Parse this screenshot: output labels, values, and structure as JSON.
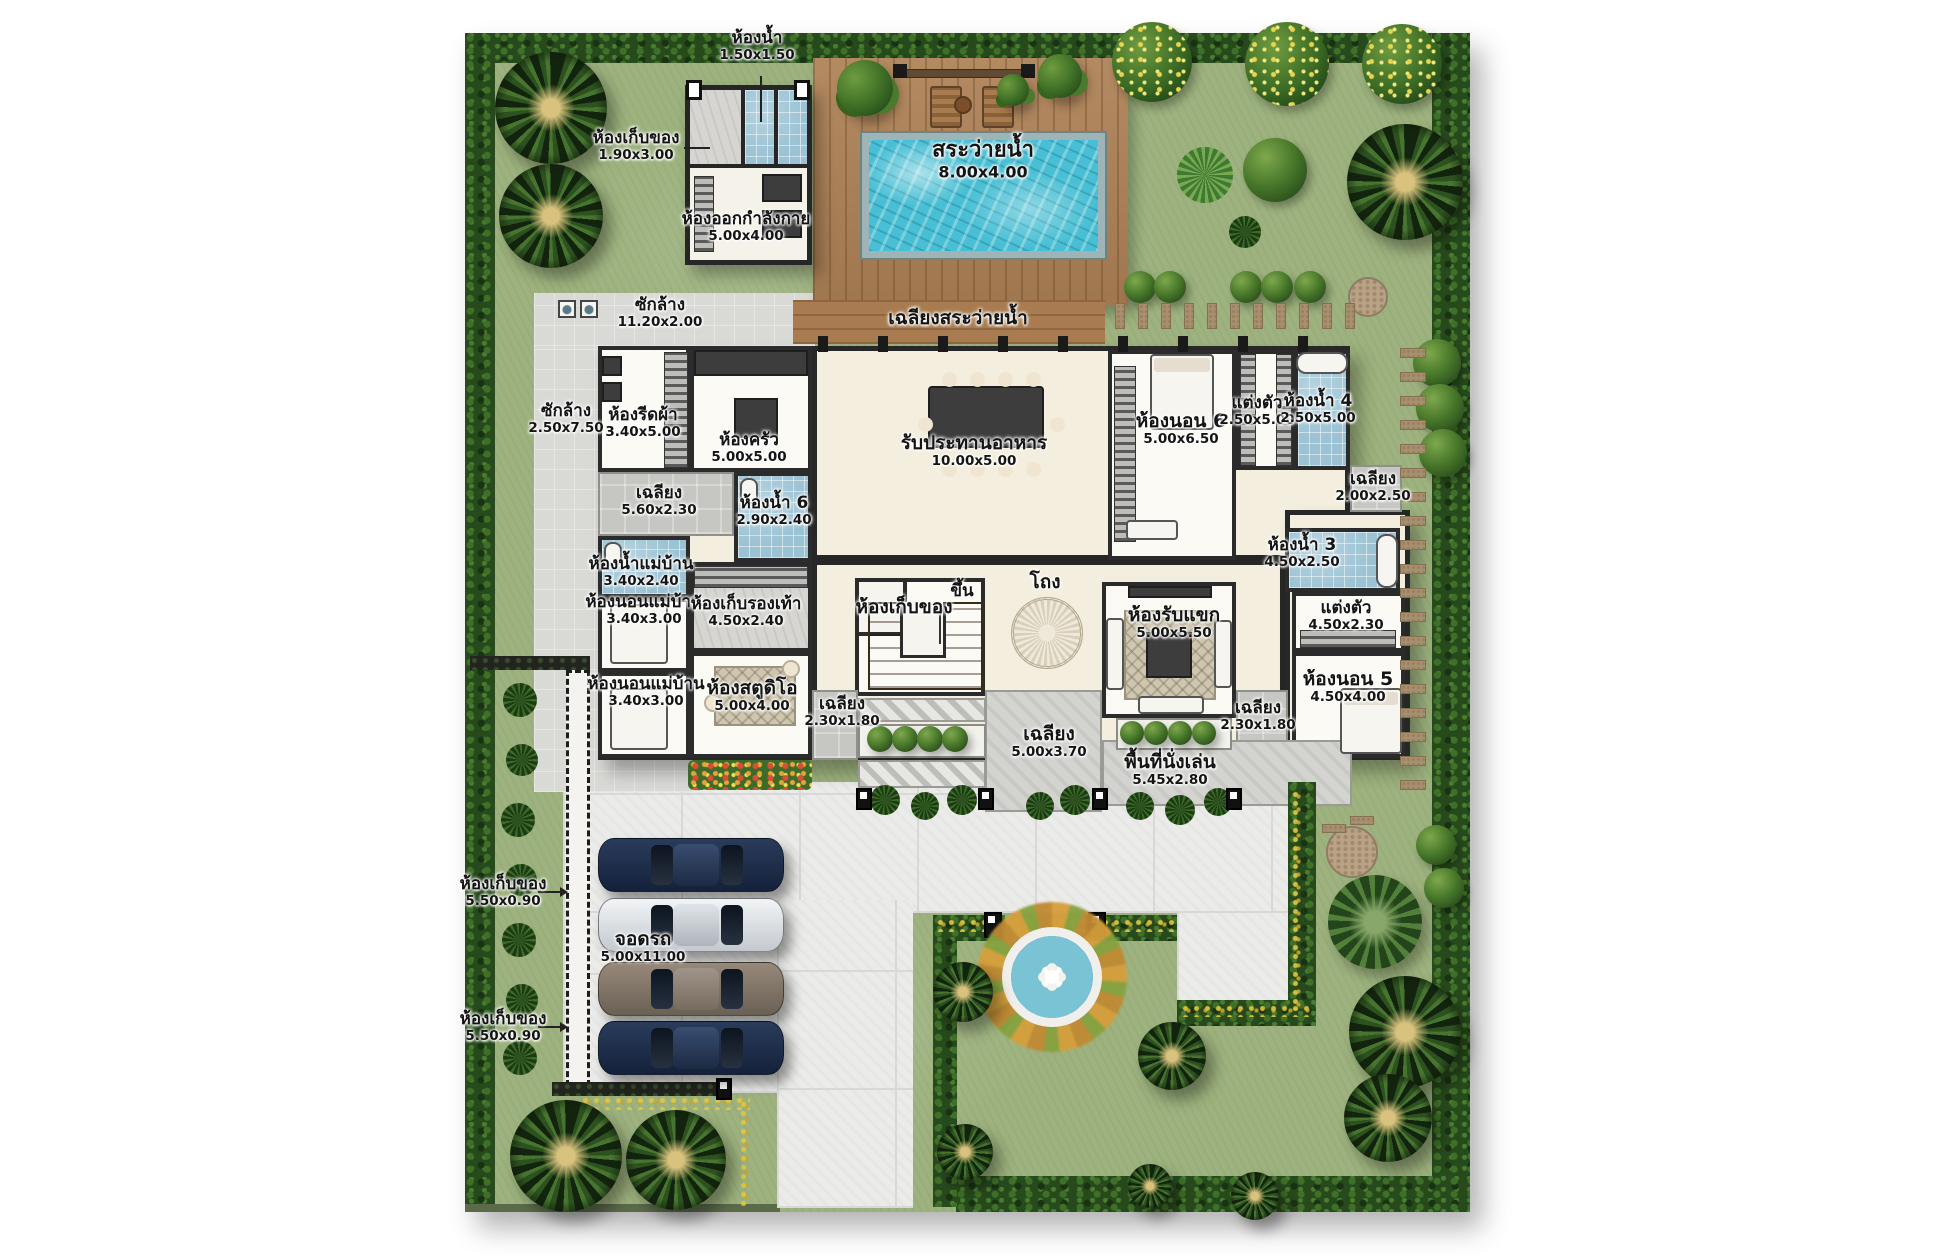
{
  "plan": {
    "rooms": {
      "bath_top": {
        "name": "ห้องน้ำ",
        "dim": "1.50x1.50"
      },
      "storage_top": {
        "name": "ห้องเก็บของ",
        "dim": "1.90x3.00"
      },
      "gym": {
        "name": "ห้องออกกำลังกาย",
        "dim": "5.00x4.00"
      },
      "pool": {
        "name": "สระว่ายน้ำ",
        "dim": "8.00x4.00"
      },
      "laundry_strip": {
        "name": "ซักล้าง",
        "dim": "11.20x2.00"
      },
      "pool_terrace": {
        "name": "เฉลียงสระว่ายน้ำ"
      },
      "laundry_left": {
        "name": "ซักล้าง",
        "dim": "2.50x7.50"
      },
      "ironing": {
        "name": "ห้องรีดผ้า",
        "dim": "3.40x5.00"
      },
      "kitchen": {
        "name": "ห้องครัว",
        "dim": "5.00x5.00"
      },
      "dining": {
        "name": "รับประทานอาหาร",
        "dim": "10.00x5.00"
      },
      "bed6": {
        "name": "ห้องนอน 6",
        "dim": "5.00x6.50"
      },
      "dress6": {
        "name": "แต่งตัว",
        "dim": "2.50x5.00"
      },
      "bath4": {
        "name": "ห้องน้ำ 4",
        "dim": "2.50x5.00"
      },
      "terr_56": {
        "name": "เฉลียง",
        "dim": "5.60x2.30"
      },
      "bath6": {
        "name": "ห้องน้ำ 6",
        "dim": "2.90x2.40"
      },
      "terr_2025": {
        "name": "เฉลียง",
        "dim": "2.00x2.50"
      },
      "maid_bath": {
        "name": "ห้องน้ำแม่บ้าน",
        "dim": "3.40x2.40"
      },
      "maid_bed1": {
        "name": "ห้องนอนแม่บ้าน",
        "dim": "3.40x3.00"
      },
      "shoe": {
        "name": "ห้องเก็บรองเท้า",
        "dim": "4.50x2.40"
      },
      "storage_stairs": {
        "name": "ห้องเก็บของ"
      },
      "up": {
        "name": "ขึ้น"
      },
      "hall": {
        "name": "โถง"
      },
      "living": {
        "name": "ห้องรับแขก",
        "dim": "5.00x5.50"
      },
      "bath3": {
        "name": "ห้องน้ำ 3",
        "dim": "4.50x2.50"
      },
      "dress5": {
        "name": "แต่งตัว",
        "dim": "4.50x2.30"
      },
      "bed5": {
        "name": "ห้องนอน 5",
        "dim": "4.50x4.00"
      },
      "maid_bed2": {
        "name": "ห้องนอนแม่บ้าน",
        "dim": "3.40x3.00"
      },
      "studio": {
        "name": "ห้องสตูดิโอ",
        "dim": "5.00x4.00"
      },
      "terr_entry_l": {
        "name": "เฉลียง",
        "dim": "2.30x1.80"
      },
      "terr_entry_c": {
        "name": "เฉลียง",
        "dim": "5.00x3.70"
      },
      "sitting": {
        "name": "พื้นที่นั่งเล่น",
        "dim": "5.45x2.80"
      },
      "terr_entry_r": {
        "name": "เฉลียง",
        "dim": "2.30x1.80"
      },
      "gstor1": {
        "name": "ห้องเก็บของ",
        "dim": "5.50x0.90"
      },
      "parking": {
        "name": "จอดรถ",
        "dim": "5.00x11.00"
      },
      "gstor2": {
        "name": "ห้องเก็บของ",
        "dim": "5.50x0.90"
      }
    },
    "palette": {
      "lawn": "#9db27e",
      "hedge": "#274a1d",
      "water": "#48bfd4",
      "deck_wood": "#ad8155",
      "wall": "#2b2b2b",
      "floor_cream": "#f3eedd",
      "floor_white": "#fbfaf5",
      "tile_blue": "#9cc3d4",
      "driveway": "#ebebe9",
      "stone_pad": "#c6c6c2",
      "flower_yellow": "#e3c83e",
      "car_navy": "#1d2b45",
      "car_silver": "#e8eaec",
      "car_bronze": "#8d8578"
    }
  }
}
